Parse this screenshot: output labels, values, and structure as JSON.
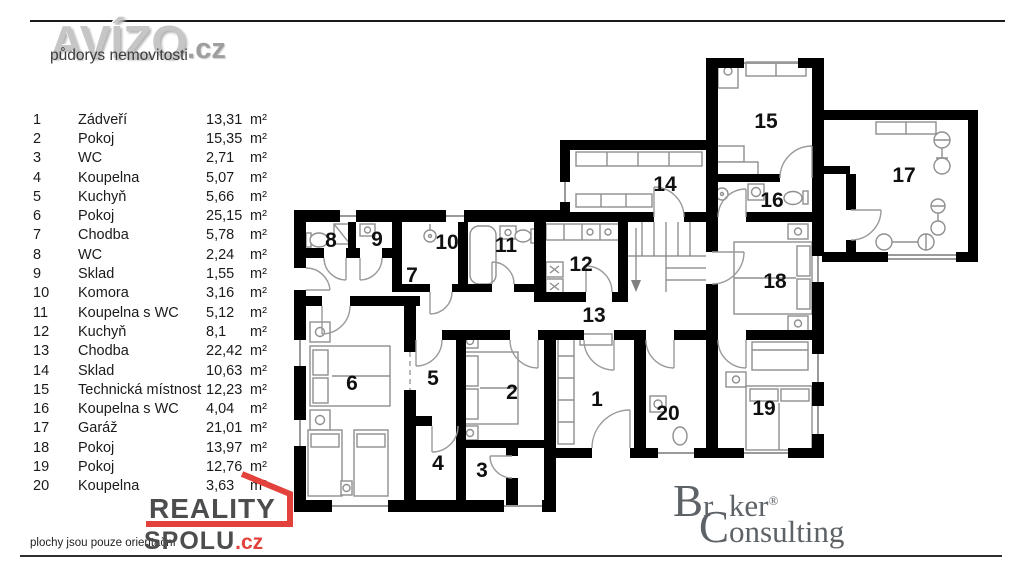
{
  "header": {
    "brand": "AVÍZO",
    "brand_tld": ".cz",
    "subtitle": "půdorys nemovitosti"
  },
  "legend": {
    "rooms": [
      {
        "number": "1",
        "name": "Zádveří",
        "area": "13,31",
        "unit": "m²"
      },
      {
        "number": "2",
        "name": "Pokoj",
        "area": "15,35",
        "unit": "m²"
      },
      {
        "number": "3",
        "name": "WC",
        "area": "2,71",
        "unit": "m²"
      },
      {
        "number": "4",
        "name": "Koupelna",
        "area": "5,07",
        "unit": "m²"
      },
      {
        "number": "5",
        "name": "Kuchyň",
        "area": "5,66",
        "unit": "m²"
      },
      {
        "number": "6",
        "name": "Pokoj",
        "area": "25,15",
        "unit": "m²"
      },
      {
        "number": "7",
        "name": "Chodba",
        "area": "5,78",
        "unit": "m²"
      },
      {
        "number": "8",
        "name": "WC",
        "area": "2,24",
        "unit": "m²"
      },
      {
        "number": "9",
        "name": "Sklad",
        "area": "1,55",
        "unit": "m²"
      },
      {
        "number": "10",
        "name": "Komora",
        "area": "3,16",
        "unit": "m²"
      },
      {
        "number": "11",
        "name": "Koupelna s WC",
        "area": "5,12",
        "unit": "m²"
      },
      {
        "number": "12",
        "name": "Kuchyň",
        "area": "8,1",
        "unit": "m²"
      },
      {
        "number": "13",
        "name": "Chodba",
        "area": "22,42",
        "unit": "m²"
      },
      {
        "number": "14",
        "name": "Sklad",
        "area": "10,63",
        "unit": "m²"
      },
      {
        "number": "15",
        "name": "Technická místnost",
        "area": "12,23",
        "unit": "m²"
      },
      {
        "number": "16",
        "name": "Koupelna s WC",
        "area": "4,04",
        "unit": "m²"
      },
      {
        "number": "17",
        "name": "Garáž",
        "area": "21,01",
        "unit": "m²"
      },
      {
        "number": "18",
        "name": "Pokoj",
        "area": "13,97",
        "unit": "m²"
      },
      {
        "number": "19",
        "name": "Pokoj",
        "area": "12,76",
        "unit": "m²"
      },
      {
        "number": "20",
        "name": "Koupelna",
        "area": "3,63",
        "unit": "m²"
      }
    ]
  },
  "footer": {
    "disclaimer": "plochy jsou pouze orientační",
    "reality_logo": {
      "line1": "REALITY",
      "line2": "SPOLU",
      "tld": ".cz"
    },
    "broker_logo": {
      "b_cap": "B",
      "b_r1": "r",
      "b_hl_white": "o",
      "b_hl_dark": "k",
      "b_r2": "er",
      "registered": "®",
      "c_cap": "C",
      "c_rest": "onsulting"
    }
  },
  "colors": {
    "wall": "#000000",
    "furniture-gray": "#8f8f8f",
    "accent-red": "#e2423b",
    "logo-gray": "#c6c6c6",
    "logo-gray-dark": "#9e9e9e",
    "text-dark": "#4c4d4f",
    "broker-gray": "#5d6267",
    "broker-red": "#e0584e"
  }
}
